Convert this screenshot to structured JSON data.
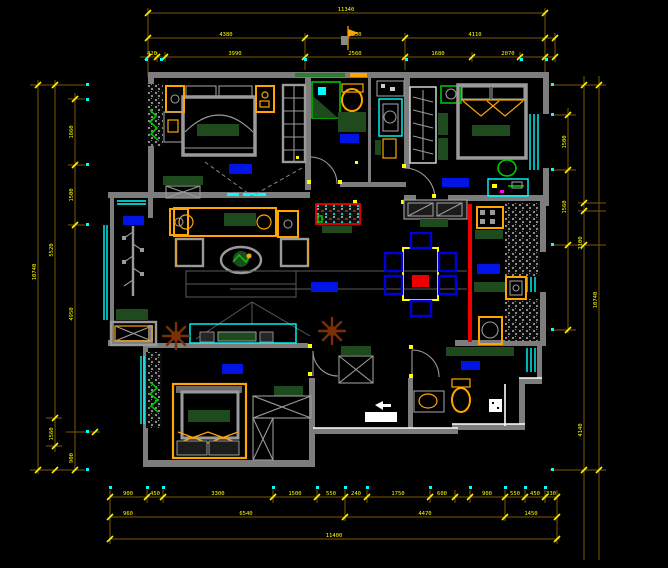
{
  "drawing": {
    "type": "apartment-floor-plan-cad",
    "room_label_blocks": [
      "balcony",
      "living-room",
      "bedroom-1",
      "bathroom-1",
      "utility",
      "bedroom-2",
      "bedroom-3",
      "kitchen",
      "bathroom-2",
      "dining"
    ],
    "colors": {
      "background": "#000000",
      "wall_gray": "#7d7d7d",
      "wall_white": "#ffffff",
      "window_cyan": "#00ffff",
      "dimension_line": "#7a5a00",
      "dimension_text": "#ffff00",
      "furniture_orange": "#ffa500",
      "furniture_dark_green": "#1e4a1e",
      "plant_bright_green": "#00c400",
      "room_label_blue": "#0014e6",
      "sliding_door_red": "#ee0000",
      "chair_blue": "#0000dd",
      "plant_brown": "#7b2f04"
    }
  },
  "dims": {
    "top": {
      "row1": [
        {
          "t": "11340"
        }
      ],
      "row2": [
        {
          "t": "4380"
        },
        {
          "t": "2850"
        },
        {
          "t": "4110"
        }
      ],
      "row3": [
        {
          "t": "420"
        },
        {
          "t": "3990"
        },
        {
          "t": "2560"
        },
        {
          "t": "1680"
        },
        {
          "t": "2070"
        }
      ]
    },
    "bottom": {
      "row1": [
        {
          "t": "900"
        },
        {
          "t": "450"
        },
        {
          "t": "3300"
        },
        {
          "t": "1500"
        },
        {
          "t": "550"
        },
        {
          "t": "240"
        },
        {
          "t": "1750"
        },
        {
          "t": "600"
        },
        {
          "t": "900"
        },
        {
          "t": "550"
        },
        {
          "t": "450"
        },
        {
          "t": "330"
        }
      ],
      "row2": [
        {
          "t": "960"
        },
        {
          "t": "6540"
        },
        {
          "t": "4470"
        },
        {
          "t": "1450"
        }
      ],
      "row3": [
        {
          "t": "11400"
        }
      ]
    },
    "left": {
      "outer": [
        {
          "t": "10740"
        }
      ],
      "mid": [
        {
          "t": "5520"
        },
        {
          "t": "1560"
        }
      ],
      "inner": [
        {
          "t": "1860"
        },
        {
          "t": "1500"
        },
        {
          "t": "4950"
        },
        {
          "t": "900"
        }
      ]
    },
    "right": {
      "inner": [
        {
          "t": "1500"
        },
        {
          "t": "1560"
        }
      ],
      "mid": [
        {
          "t": "2100"
        },
        {
          "t": "4140"
        }
      ],
      "outer": [
        {
          "t": "10740"
        }
      ]
    }
  }
}
